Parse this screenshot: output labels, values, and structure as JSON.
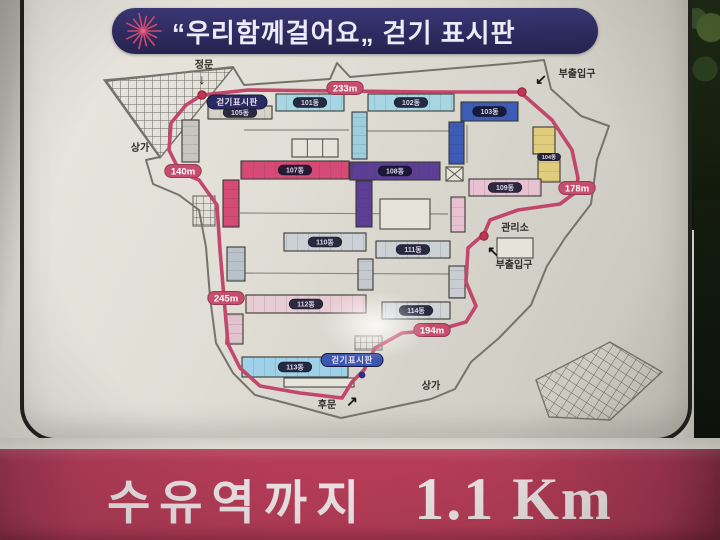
{
  "title": {
    "text": "“우리함께걸어요„ 걷기 표시판"
  },
  "banner": {
    "station": "수유역까지",
    "distance": "1.1 Km"
  },
  "colors": {
    "route": "#c2476a",
    "marker_bg": "#c64d6e",
    "marker_border": "#963a54",
    "dot": "#c23552",
    "nav_dot": "#2b3380",
    "outline": "#75746b",
    "label_text": "#2d2c27",
    "arrow": "#14130f",
    "title_bg": "#2e2b60",
    "banner_bg": "#b53c57",
    "starburst": "#d14a70"
  },
  "map": {
    "boundary": "M233,67 L244,85 L330,79 L337,63 L350,77 L516,63 L544,60 L551,89 L581,116 L609,126 L597,160 L591,204 L565,238 L547,266 L531,305 L499,338 L471,362 L455,389 L431,399 L341,418 L297,406 L255,395 L233,373 L216,343 L210,297 L206,247 L199,210 L179,195 L153,184 L146,160 L160,157 L106,81 Z",
    "roads": [
      "M244,130 L349,130",
      "M367,131 L449,131",
      "M240,213 L448,214",
      "M236,273 L450,274",
      "M467,125 L467,163"
    ],
    "route": [
      [
        202,
        95
      ],
      [
        248,
        90
      ],
      [
        430,
        92
      ],
      [
        520,
        92
      ],
      [
        552,
        120
      ],
      [
        572,
        150
      ],
      [
        578,
        178
      ],
      [
        576,
        192
      ],
      [
        560,
        204
      ],
      [
        518,
        210
      ],
      [
        490,
        220
      ],
      [
        484,
        234
      ],
      [
        468,
        248
      ],
      [
        466,
        282
      ],
      [
        476,
        306
      ],
      [
        466,
        322
      ],
      [
        438,
        330
      ],
      [
        402,
        333
      ],
      [
        375,
        348
      ],
      [
        364,
        370
      ],
      [
        352,
        382
      ],
      [
        342,
        398
      ],
      [
        300,
        393
      ],
      [
        260,
        386
      ],
      [
        240,
        368
      ],
      [
        228,
        344
      ],
      [
        224,
        298
      ],
      [
        220,
        250
      ],
      [
        217,
        205
      ],
      [
        199,
        180
      ],
      [
        180,
        172
      ],
      [
        169,
        150
      ],
      [
        171,
        123
      ],
      [
        186,
        105
      ],
      [
        202,
        95
      ]
    ],
    "dots": [
      [
        202,
        95
      ],
      [
        522,
        92
      ],
      [
        484,
        236
      ]
    ],
    "nav_dot": [
      362,
      375
    ],
    "markers": [
      {
        "text": "233m",
        "x": 345,
        "y": 88
      },
      {
        "text": "140m",
        "x": 183,
        "y": 171
      },
      {
        "text": "178m",
        "x": 577,
        "y": 188
      },
      {
        "text": "245m",
        "x": 226,
        "y": 298
      },
      {
        "text": "194m",
        "x": 432,
        "y": 330
      }
    ],
    "sign_ovals": [
      {
        "text": "걷기표시판",
        "x": 237,
        "y": 102,
        "w": 60,
        "h": 14,
        "bg": "#2b2a60"
      },
      {
        "text": "걷기표시판",
        "x": 352,
        "y": 360,
        "w": 62,
        "h": 13,
        "bg": "#3c57ae"
      }
    ],
    "labels": [
      {
        "text": "정문",
        "x": 204,
        "y": 68,
        "arrow": "↓",
        "ax": 202,
        "ay": 84
      },
      {
        "text": "부출입구",
        "x": 577,
        "y": 77,
        "arrow": "↙",
        "ax": 541,
        "ay": 84
      },
      {
        "text": "부출입구",
        "x": 514,
        "y": 268,
        "arrow": "↖",
        "ax": 493,
        "ay": 256
      },
      {
        "text": "관리소",
        "x": 515,
        "y": 231
      },
      {
        "text": "후문",
        "x": 327,
        "y": 408,
        "arrow": "↗",
        "ax": 352,
        "ay": 406
      },
      {
        "text": "상가",
        "x": 140,
        "y": 151
      },
      {
        "text": "상가",
        "x": 431,
        "y": 389
      }
    ],
    "buildings": [
      {
        "name": "101",
        "x": 276,
        "y": 94,
        "w": 68,
        "h": 17,
        "color": "#a6d6e3",
        "label": "101동",
        "dir": "h"
      },
      {
        "name": "102",
        "x": 368,
        "y": 94,
        "w": 86,
        "h": 17,
        "color": "#a6d6e3",
        "label": "102동",
        "dir": "h"
      },
      {
        "name": "conn-102",
        "x": 352,
        "y": 112,
        "w": 15,
        "h": 47,
        "color": "#9ccede",
        "dir": "v"
      },
      {
        "name": "103",
        "x": 461,
        "y": 102,
        "w": 57,
        "h": 19,
        "color": "#3e5cb6",
        "label": "103동",
        "dir": "h"
      },
      {
        "name": "conn-103",
        "x": 449,
        "y": 122,
        "w": 15,
        "h": 42,
        "color": "#3e5cb6",
        "dir": "v"
      },
      {
        "name": "104a",
        "x": 533,
        "y": 127,
        "w": 22,
        "h": 27,
        "color": "#e1cc7c",
        "dir": "v"
      },
      {
        "name": "104b",
        "x": 538,
        "y": 160,
        "w": 22,
        "h": 22,
        "color": "#e1cc7c",
        "dir": "v"
      },
      {
        "name": "105",
        "x": 208,
        "y": 106,
        "w": 64,
        "h": 13,
        "color": "#d6d4c9",
        "label": "105동",
        "dir": "h"
      },
      {
        "name": "conn-105",
        "x": 182,
        "y": 120,
        "w": 17,
        "h": 42,
        "color": "#c8c6bd",
        "dir": "v"
      },
      {
        "name": "107",
        "x": 241,
        "y": 161,
        "w": 108,
        "h": 18,
        "color": "#d64a78",
        "label": "107동",
        "dir": "h"
      },
      {
        "name": "conn-107",
        "x": 223,
        "y": 180,
        "w": 16,
        "h": 47,
        "color": "#d64a78",
        "dir": "v"
      },
      {
        "name": "108",
        "x": 350,
        "y": 162,
        "w": 90,
        "h": 18,
        "color": "#5c3f94",
        "label": "108동",
        "dir": "h"
      },
      {
        "name": "conn-108",
        "x": 356,
        "y": 181,
        "w": 16,
        "h": 46,
        "color": "#5c3f94",
        "dir": "v"
      },
      {
        "name": "109",
        "x": 469,
        "y": 179,
        "w": 72,
        "h": 17,
        "color": "#e9c2d2",
        "label": "109동",
        "dir": "h"
      },
      {
        "name": "conn-109",
        "x": 451,
        "y": 197,
        "w": 14,
        "h": 35,
        "color": "#e9c2d2",
        "dir": "v"
      },
      {
        "name": "110",
        "x": 284,
        "y": 233,
        "w": 82,
        "h": 18,
        "color": "#ccd1d5",
        "label": "110동",
        "dir": "h"
      },
      {
        "name": "111",
        "x": 376,
        "y": 241,
        "w": 74,
        "h": 17,
        "color": "#ccd1d5",
        "label": "111동",
        "dir": "h"
      },
      {
        "name": "conn-111",
        "x": 358,
        "y": 259,
        "w": 15,
        "h": 31,
        "color": "#c4c9ce",
        "dir": "v"
      },
      {
        "name": "112",
        "x": 246,
        "y": 295,
        "w": 120,
        "h": 18,
        "color": "#e8ccd4",
        "label": "112동",
        "dir": "h"
      },
      {
        "name": "114",
        "x": 382,
        "y": 302,
        "w": 68,
        "h": 17,
        "color": "#d2d3d7",
        "label": "114동",
        "dir": "h"
      },
      {
        "name": "conn-left-a",
        "x": 227,
        "y": 247,
        "w": 18,
        "h": 34,
        "color": "#b9c2cb",
        "dir": "v"
      },
      {
        "name": "conn-left-b",
        "x": 226,
        "y": 314,
        "w": 17,
        "h": 30,
        "color": "#e1c3cd",
        "dir": "v"
      },
      {
        "name": "conn-right",
        "x": 449,
        "y": 266,
        "w": 16,
        "h": 32,
        "color": "#c9ccd1",
        "dir": "v"
      },
      {
        "name": "113",
        "x": 242,
        "y": 357,
        "w": 106,
        "h": 20,
        "color": "#9fd2e8",
        "label": "113동",
        "dir": "h"
      }
    ],
    "tiny_label": {
      "text": "104동",
      "x": 549,
      "y": 157
    },
    "boxes": [
      {
        "x": 292,
        "y": 139,
        "w": 46,
        "h": 18,
        "cells": 3
      },
      {
        "x": 380,
        "y": 199,
        "w": 50,
        "h": 30
      },
      {
        "x": 446,
        "y": 167,
        "w": 17,
        "h": 14,
        "cross": true
      },
      {
        "x": 497,
        "y": 238,
        "w": 36,
        "h": 20
      },
      {
        "x": 284,
        "y": 378,
        "w": 70,
        "h": 9
      }
    ],
    "hatches": [
      {
        "type": "poly",
        "points": "104,80 233,68 160,158",
        "grid": 8
      },
      {
        "type": "rect",
        "x": 193,
        "y": 196,
        "w": 22,
        "h": 30,
        "grid": 7
      },
      {
        "type": "rect",
        "x": 355,
        "y": 336,
        "w": 27,
        "h": 14,
        "grid": 6
      },
      {
        "type": "poly",
        "points": "536,380 610,342 662,372 610,420 549,417",
        "grid": 9,
        "rotate": 33
      }
    ]
  }
}
